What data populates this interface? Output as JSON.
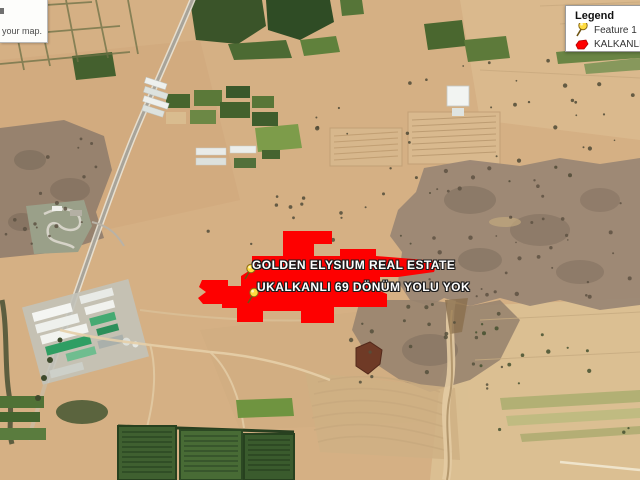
{
  "map": {
    "placemarks": [
      {
        "label": "GOLDEN ELYSIUM REAL ESTATE"
      },
      {
        "label": "UKALKANLI 69 DÖNÜM YOLU YOK"
      }
    ]
  },
  "legend": {
    "title": "Legend",
    "items": [
      {
        "label": "Feature 1",
        "icon": "pushpin-icon"
      },
      {
        "label": "KALKANLI 69",
        "icon": "red-polygon-icon"
      }
    ]
  },
  "info_box": {
    "text": "your map."
  },
  "colors": {
    "overlay_red": "#fe0000",
    "overlay_red_edge": "#c40000",
    "pushpin_yellow": "#ffdc3f",
    "legend_bg": "#ffffff"
  }
}
